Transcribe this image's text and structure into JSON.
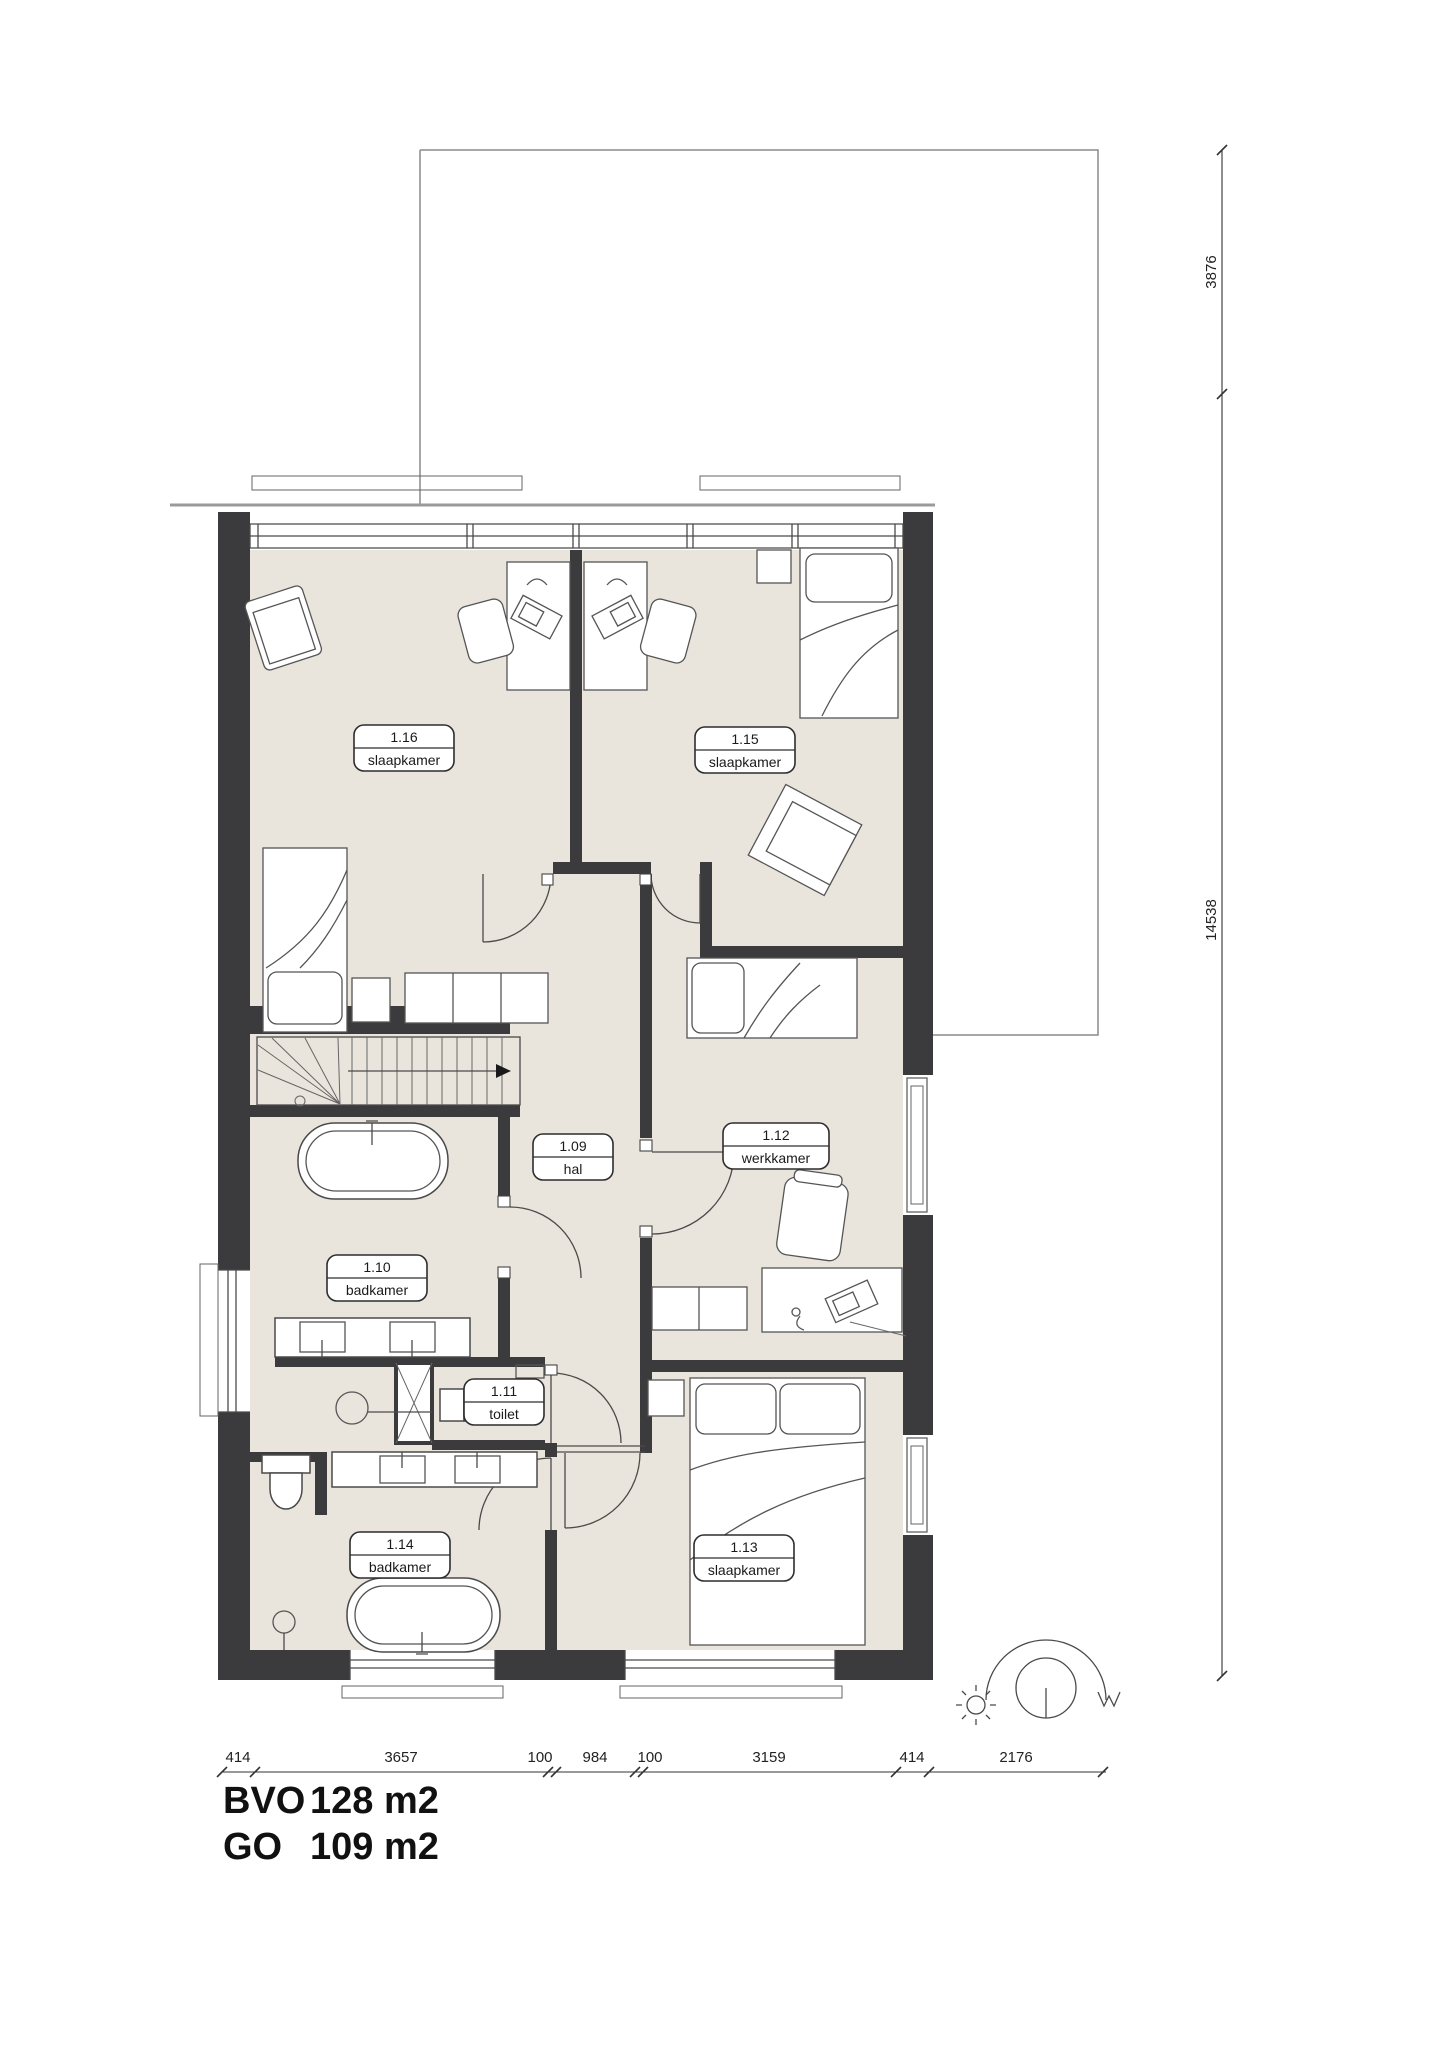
{
  "plan": {
    "title_block": {
      "areas": [
        {
          "label": "BVO",
          "value": "128 m2"
        },
        {
          "label": "GO",
          "value": "109 m2"
        }
      ]
    },
    "rooms": [
      {
        "number": "1.16",
        "name": "slaapkamer"
      },
      {
        "number": "1.15",
        "name": "slaapkamer"
      },
      {
        "number": "1.09",
        "name": "hal"
      },
      {
        "number": "1.10",
        "name": "badkamer"
      },
      {
        "number": "1.11",
        "name": "toilet"
      },
      {
        "number": "1.12",
        "name": "werkkamer"
      },
      {
        "number": "1.13",
        "name": "slaapkamer"
      },
      {
        "number": "1.14",
        "name": "badkamer"
      }
    ],
    "dimensions_bottom": [
      "414",
      "3657",
      "100",
      "984",
      "100",
      "3159",
      "414",
      "2176"
    ],
    "dimensions_right": [
      "3876",
      "14538"
    ],
    "colors": {
      "wall": "#3b3b3d",
      "floor": "#eae5dc",
      "accent_line": "#4a4a4a"
    }
  }
}
